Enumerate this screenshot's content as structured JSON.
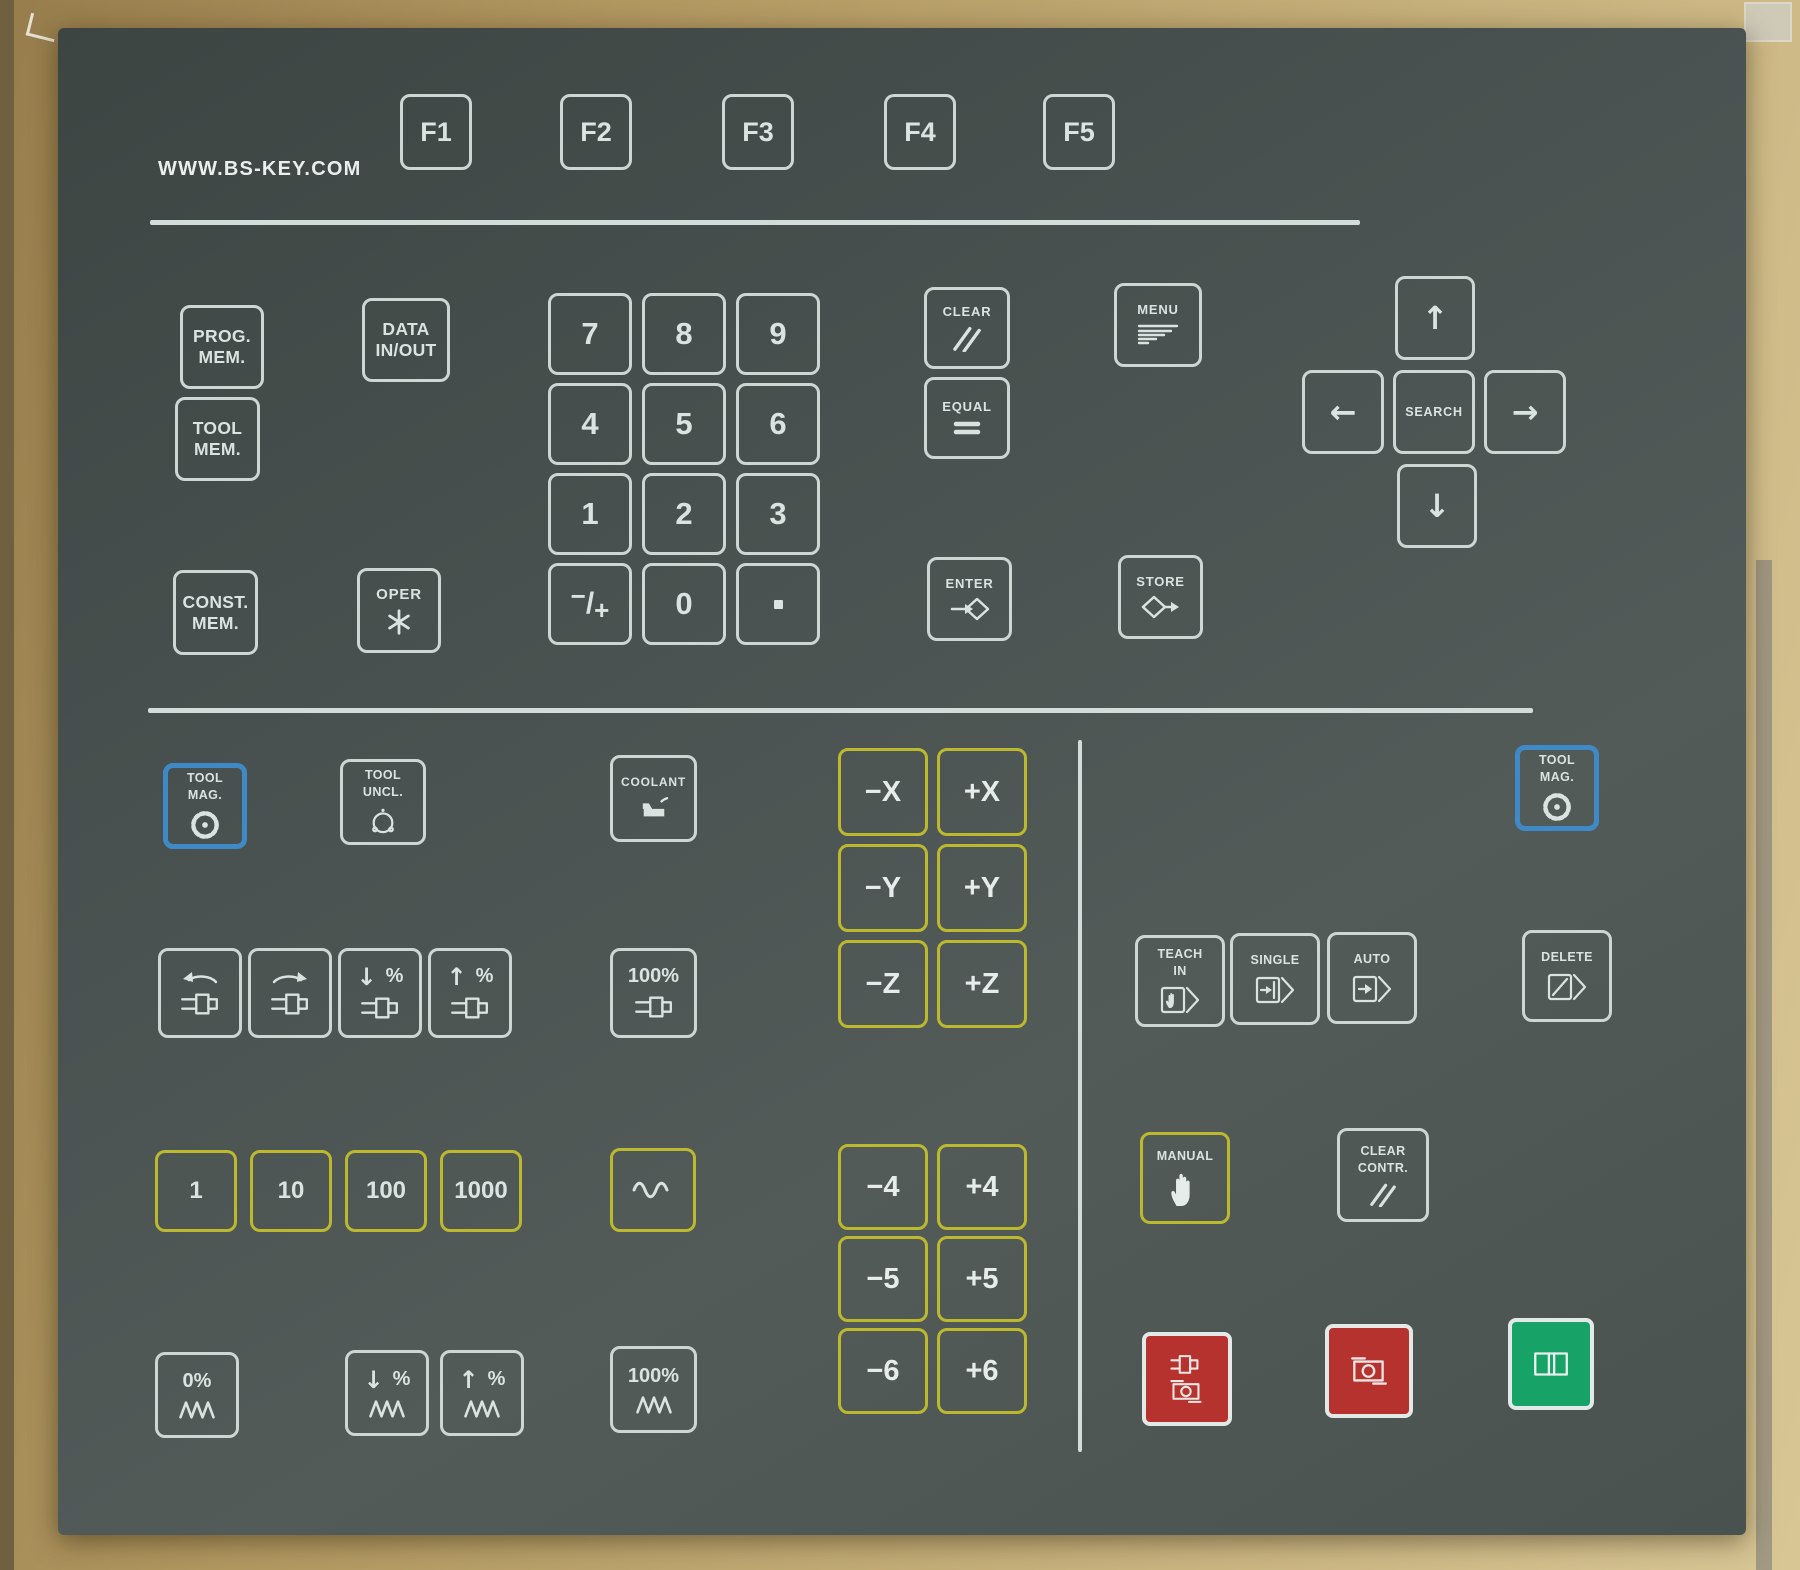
{
  "brand": {
    "label": "WWW.BS-KEY.COM"
  },
  "function_keys": {
    "f1": "F1",
    "f2": "F2",
    "f3": "F3",
    "f4": "F4",
    "f5": "F5"
  },
  "memory_keys": {
    "prog_mem": {
      "line1": "PROG.",
      "line2": "MEM."
    },
    "tool_mem": {
      "line1": "TOOL",
      "line2": "MEM."
    },
    "const_mem": {
      "line1": "CONST.",
      "line2": "MEM."
    },
    "data_in_out": {
      "line1": "DATA",
      "line2": "IN/OUT"
    },
    "oper": {
      "label": "OPER"
    }
  },
  "numpad": {
    "d7": "7",
    "d8": "8",
    "d9": "9",
    "d4": "4",
    "d5": "5",
    "d6": "6",
    "d1": "1",
    "d2": "2",
    "d3": "3",
    "d0": "0",
    "sign_minus": "−",
    "sign_slash": "/",
    "sign_plus": "+",
    "decimal": "."
  },
  "edit_keys": {
    "clear": "CLEAR",
    "equal": "EQUAL",
    "enter": "ENTER",
    "store": "STORE",
    "menu": "MENU"
  },
  "nav_keys": {
    "search": "SEARCH",
    "up": "↑",
    "down": "↓",
    "left": "←",
    "right": "→"
  },
  "tool_keys": {
    "tool_mag_left": {
      "line1": "TOOL",
      "line2": "MAG."
    },
    "tool_uncl": {
      "line1": "TOOL",
      "line2": "UNCL."
    },
    "tool_mag_right": {
      "line1": "TOOL",
      "line2": "MAG."
    }
  },
  "coolant_key": {
    "label": "COOLANT"
  },
  "spindle_keys": {
    "override_down_pct": "%",
    "override_up_pct": "%",
    "override_100": "100%"
  },
  "feed_keys": {
    "override_0": "0%",
    "override_down_pct": "%",
    "override_up_pct": "%",
    "override_100": "100%"
  },
  "jog_step_keys": {
    "s1": "1",
    "s10": "10",
    "s100": "100",
    "s1000": "1000"
  },
  "axis_keys": {
    "x_minus": "−X",
    "x_plus": "+X",
    "y_minus": "−Y",
    "y_plus": "+Y",
    "z_minus": "−Z",
    "z_plus": "+Z",
    "a4_minus": "−4",
    "a4_plus": "+4",
    "a5_minus": "−5",
    "a5_plus": "+5",
    "a6_minus": "−6",
    "a6_plus": "+6"
  },
  "mode_keys": {
    "teach_in": {
      "line1": "TEACH",
      "line2": "IN"
    },
    "single": {
      "label": "SINGLE"
    },
    "auto": {
      "label": "AUTO"
    },
    "delete": {
      "label": "DELETE"
    },
    "manual": {
      "label": "MANUAL"
    },
    "clear_contr": {
      "line1": "CLEAR",
      "line2": "CONTR."
    }
  },
  "colors": {
    "panel": "#4a5250",
    "key_outline": "#ccd7d4",
    "axis_yellow": "#bdb92e",
    "tool_blue": "#3f8ac6",
    "stop_red": "#b5322e",
    "start_green": "#17a268",
    "cardboard": "#bca670"
  }
}
